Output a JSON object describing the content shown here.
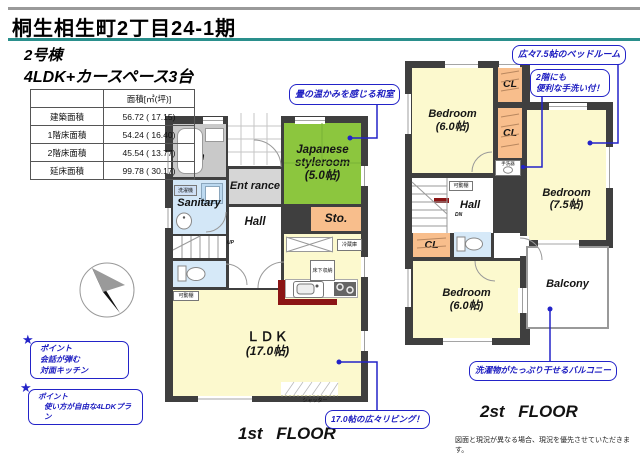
{
  "header": {
    "title": "桐生相生町2丁目24-1期"
  },
  "building": {
    "name": "2号棟",
    "layout": "4LDK+カースペース3台"
  },
  "area_table": {
    "unit_header": "面積[㎡(坪)]",
    "rows": [
      {
        "label": "建築面積",
        "value": "56.72 ( 17.15)"
      },
      {
        "label": "1階床面積",
        "value": "54.24 ( 16.40)"
      },
      {
        "label": "2階床面積",
        "value": "45.54 ( 13.77)"
      },
      {
        "label": "延床面積",
        "value": "99.78 ( 30.17)"
      }
    ]
  },
  "floor1": {
    "caption": "1st FLOOR",
    "rooms": {
      "bath": "Bath room",
      "sanitary": "Sanitary",
      "entrance": "Ent rance",
      "japanese_name": "Japanese styleroom",
      "japanese_size": "(5.0帖)",
      "storage": "Sto.",
      "hall": "Hall",
      "ldk_name": "ＬＤＫ",
      "ldk_size": "(17.0帖)"
    },
    "labels": {
      "washer": "洗濯機",
      "up": "UP",
      "movable_shelf": "可動棚",
      "underfloor_storage": "床下収納",
      "refrigerator": "冷蔵庫",
      "shutter": "シャッター"
    }
  },
  "floor2": {
    "caption": "2st FLOOR",
    "rooms": {
      "bedroom1_name": "Bedroom",
      "bedroom1_size": "(6.0帖)",
      "cl": "CL",
      "bedroom2_name": "Bedroom",
      "bedroom2_size": "(7.5帖)",
      "hall": "Hall",
      "bedroom3_name": "Bedroom",
      "bedroom3_size": "(6.0帖)",
      "balcony": "Balcony"
    },
    "labels": {
      "hand_wash": "手洗器",
      "movable_shelf": "可動棚",
      "down": "DN"
    }
  },
  "callouts": {
    "tatami": "畳の温かみを感じる和室",
    "bedroom75": "広々7.5帖のベッドルーム",
    "handwash_line1": "2階にも",
    "handwash_line2": "便利な手洗い付！",
    "balcony": "洗濯物がたっぷり干せるバルコニー",
    "living": "17.0帖の広々リビング！"
  },
  "points": [
    {
      "star": "★",
      "title": "ポイント",
      "line1": "会話が弾む",
      "line2": "対面キッチン"
    },
    {
      "star": "★",
      "title": "ポイント",
      "line1": "使い方が自由な4LDKプラン",
      "line2": ""
    }
  ],
  "footer": {
    "disclaimer": "図面と現況が異なる場合、現況を優先させていただきます。"
  },
  "colors": {
    "accent_teal": "#2a8f8c",
    "callout_blue": "#2323c8",
    "tatami_green": "#8cc63e",
    "room_yellow": "#fcf9ce",
    "closet_orange": "#f8be8c",
    "water_blue": "#d3e7f7",
    "bath_gray": "#c9c9c9",
    "wall_dark": "#3f3f3f",
    "counter_red": "#8b1515"
  }
}
